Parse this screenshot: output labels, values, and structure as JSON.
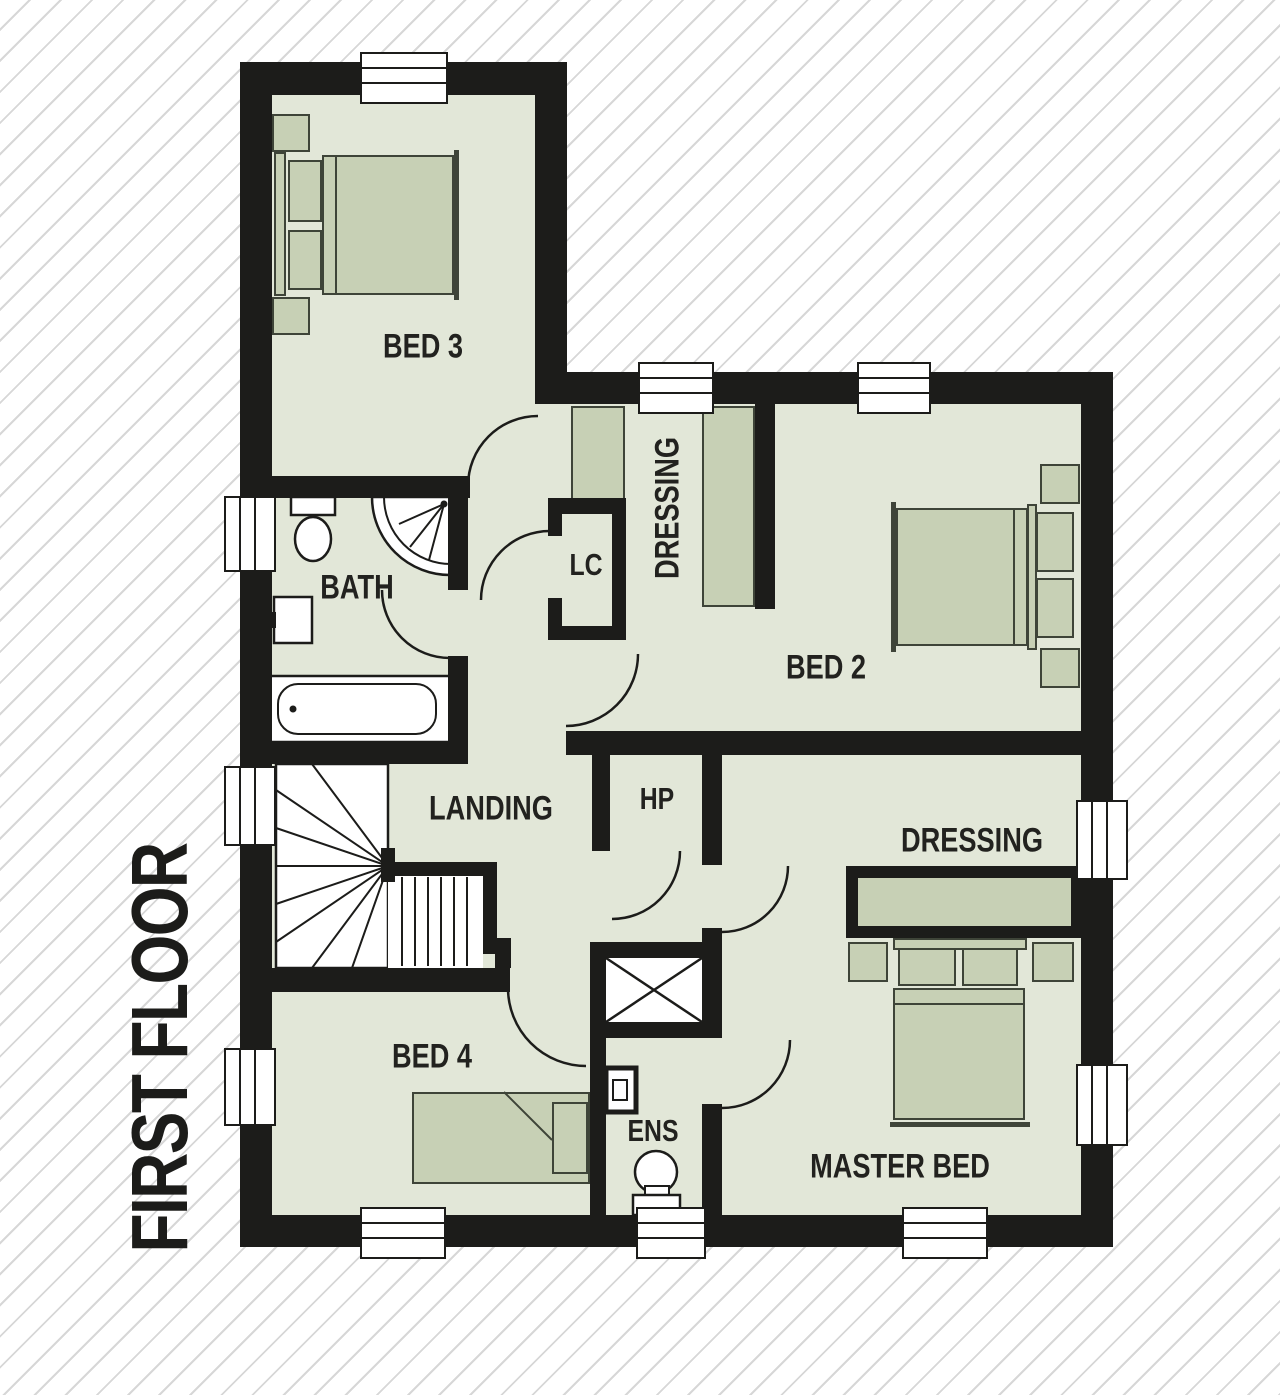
{
  "title": "FIRST FLOOR",
  "palette": {
    "wall": "#1c1c1a",
    "floor": "#e2e7d8",
    "furniture": "#c7d0b5",
    "furniture_outline": "#3e4438",
    "fixture": "#ffffff",
    "stripe": "#d7d7d7",
    "background": "#ffffff",
    "label_text": "#22221f"
  },
  "rooms": {
    "bed3": {
      "label": "BED 3"
    },
    "bath": {
      "label": "BATH"
    },
    "lc": {
      "label": "LC"
    },
    "dressing_top": {
      "label": "DRESSING"
    },
    "bed2": {
      "label": "BED 2"
    },
    "landing": {
      "label": "LANDING"
    },
    "hp": {
      "label": "HP"
    },
    "dressing_master": {
      "label": "DRESSING"
    },
    "bed4": {
      "label": "BED 4"
    },
    "ens": {
      "label": "ENS"
    },
    "master_bed": {
      "label": "MASTER BED"
    }
  },
  "fixtures": [
    "staircase",
    "bathtub",
    "corner-shower",
    "toilet",
    "wash-basin",
    "double-bed",
    "single-bed",
    "wardrobe",
    "bedside-table",
    "window",
    "door-arc",
    "rooflight"
  ]
}
